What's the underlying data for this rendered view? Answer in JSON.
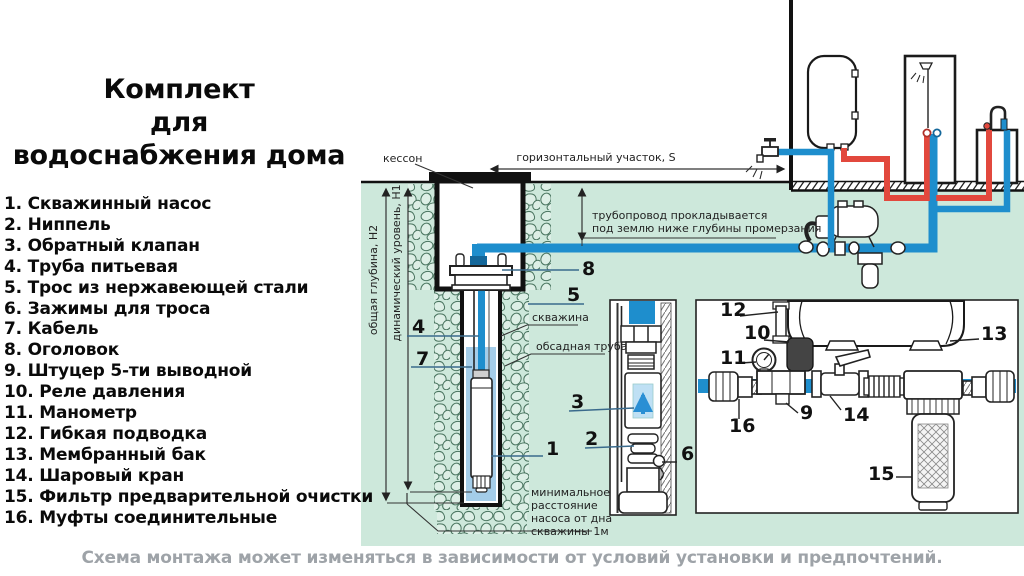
{
  "title_lines": [
    "Комплект",
    "для",
    "водоснабжения дома"
  ],
  "legend": {
    "items": [
      "1. Скважинный насос",
      "2. Ниппель",
      "3. Обратный клапан",
      "4. Труба питьевая",
      "5. Трос из нержавеющей стали",
      "6. Зажимы для троса",
      "7. Кабель",
      "8. Оголовок",
      "9. Штуцер 5-ти выводной",
      "10. Реле давления",
      "11. Манометр",
      "12. Гибкая подводка",
      "13. Мембранный бак",
      "14. Шаровый кран",
      "15. Фильтр предварительной очистки",
      "16. Муфты соединительные"
    ]
  },
  "caption": "Схема монтажа может изменяться в зависимости от условий установки и предпочтений.",
  "diagram": {
    "labels": {
      "kesson": "кессон",
      "horizontal_section": "горизонтальный участок, S",
      "pipe_note_line1": "трубопровод прокладывается",
      "pipe_note_line2": "под землю ниже глубины промерзания",
      "total_depth": "общая глубина, Н2",
      "dynamic_level": "динамический уровень, Н1",
      "borehole": "скважина",
      "casing_pipe": "обсадная труба",
      "min_distance_lines": [
        "минимальное",
        "расстояние",
        "насоса от дна",
        "скважины 1м"
      ]
    },
    "callouts": {
      "c1": "1",
      "c2": "2",
      "c3": "3",
      "c4": "4",
      "c5": "5",
      "c6": "6",
      "c7": "7",
      "c8": "8",
      "c9": "9",
      "c10": "10",
      "c11": "11",
      "c12": "12",
      "c13": "13",
      "c14": "14",
      "c15": "15",
      "c16": "16"
    },
    "colors": {
      "ground": "#cde8db",
      "pipe_cold": "#1e8ecd",
      "pipe_hot": "#e2483d",
      "stone_outline": "#49745f",
      "caption_text": "#9ea3a8"
    }
  }
}
